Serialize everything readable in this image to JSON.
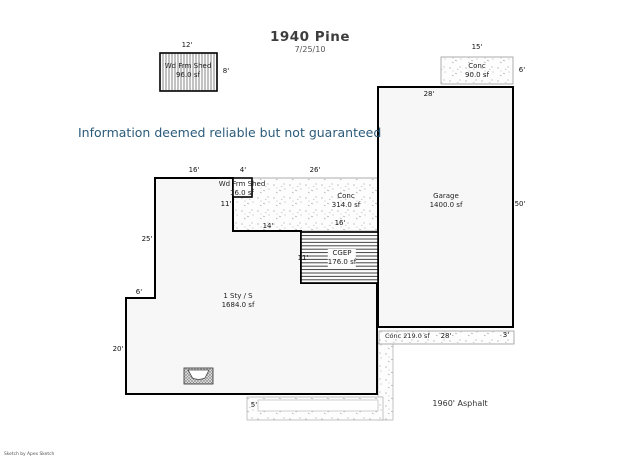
{
  "page": {
    "title": "1940 Pine",
    "date": "7/25/10",
    "disclaimer": "Information deemed reliable but not guaranteed",
    "footer": "Sketch by Apex Sketch"
  },
  "labels": {
    "shed_top_name": "Wd Frm Shed",
    "shed_top_area": "96.0 sf",
    "shed_top_w": "12'",
    "shed_top_h": "8'",
    "conc_top_name": "Conc",
    "conc_top_area": "90.0 sf",
    "conc_top_w": "15'",
    "conc_top_h": "6'",
    "garage_name": "Garage",
    "garage_area": "1400.0 sf",
    "garage_w": "28'",
    "garage_h": "50'",
    "house_name": "1 Sty / S",
    "house_area": "1684.0 sf",
    "house_left_upper": "25'",
    "house_step": "6'",
    "house_left_lower": "20'",
    "top_seg1": "16'",
    "top_seg2": "4'",
    "top_seg3": "26'",
    "patio_left": "11'",
    "patio_bottom": "14'",
    "patio_bottom_right": "16'",
    "shed_mid_name": "Wd Frm Shed",
    "shed_mid_area": "16.0 sf",
    "patio_name": "Conc",
    "patio_area": "314.0 sf",
    "cgep_name": "CGEP",
    "cgep_area": "176.0 sf",
    "cgep_h": "11'",
    "strip_label": "Conc 219.0 sf",
    "strip_w": "28'",
    "strip_h": "3'",
    "asphalt_label": "1960' Asphalt",
    "asphalt_offset": "5'"
  }
}
